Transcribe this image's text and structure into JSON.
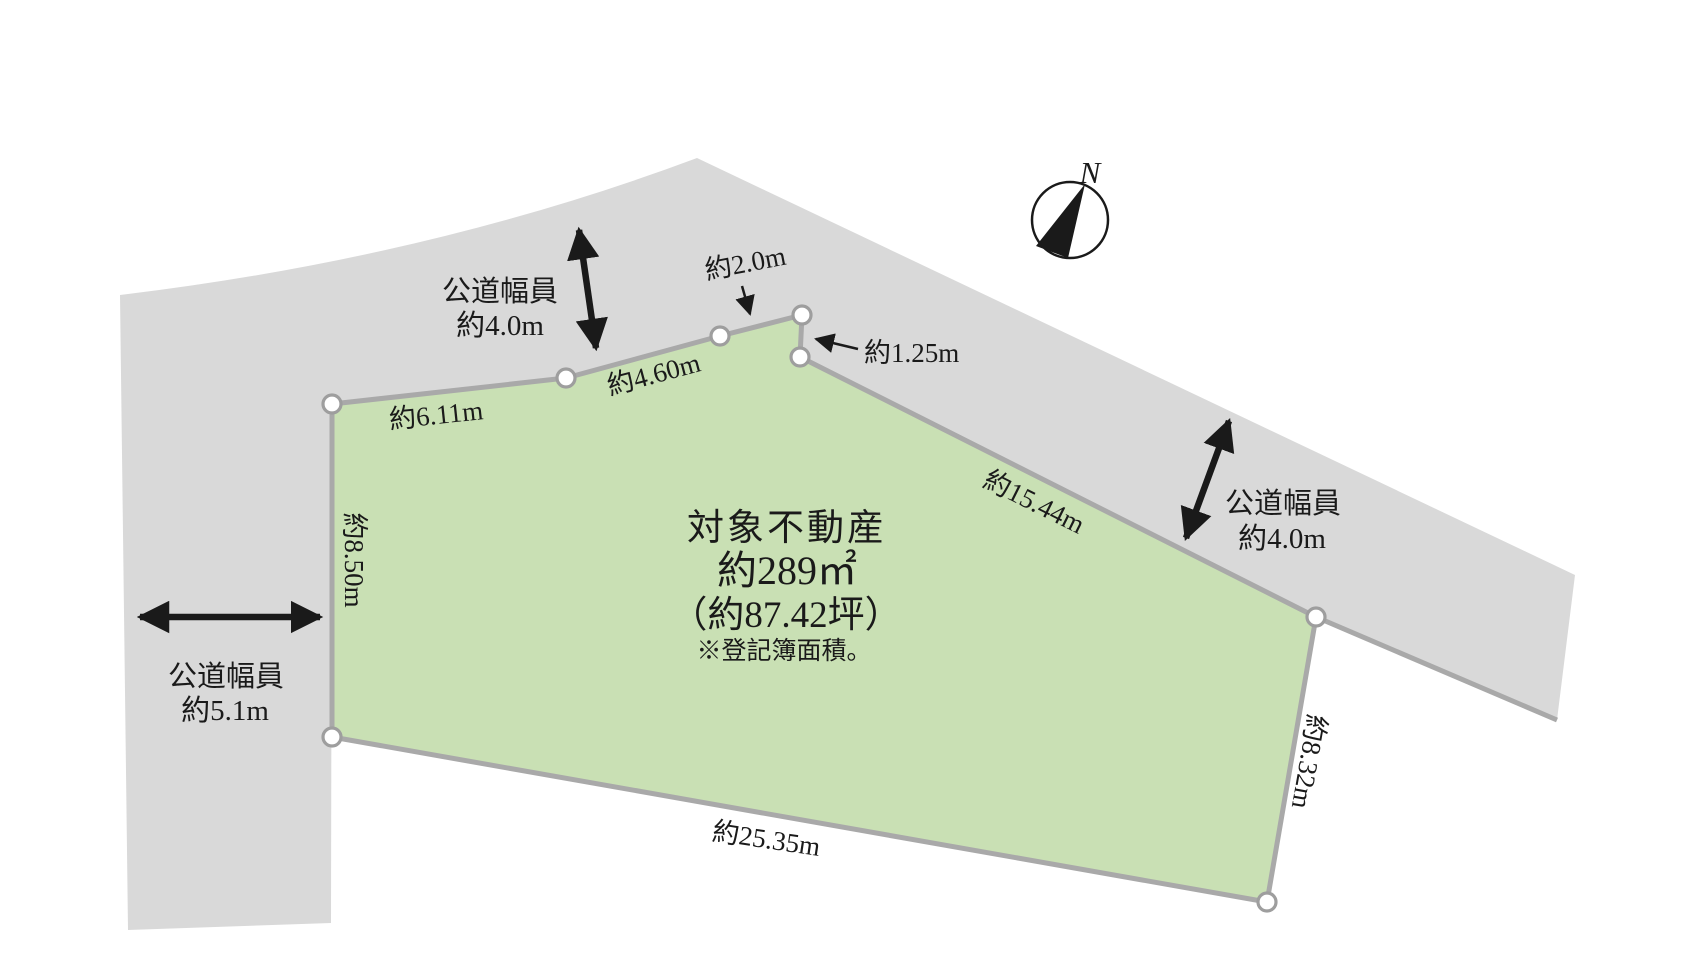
{
  "colors": {
    "road": "#d9d9d9",
    "parcel": "#c9e0b4",
    "boundary": "#a9a9a9",
    "ink": "#1a1a1a"
  },
  "compass": {
    "north": "N"
  },
  "parcel": {
    "title": "対象不動産",
    "area": "約289㎡",
    "area_tsubo": "（約87.42坪）",
    "note": "※登記簿面積。"
  },
  "edges": {
    "top_left": "約6.11m",
    "top_mid": "約4.60m",
    "top_notch": "約2.0m",
    "notch_side": "約1.25m",
    "northeast": "約15.44m",
    "east": "約8.32m",
    "south": "約25.35m",
    "west": "約8.50m"
  },
  "roads": {
    "top": {
      "name": "公道幅員",
      "width": "約4.0m"
    },
    "left": {
      "name": "公道幅員",
      "width": "約5.1m"
    },
    "right": {
      "name": "公道幅員",
      "width": "約4.0m"
    }
  }
}
